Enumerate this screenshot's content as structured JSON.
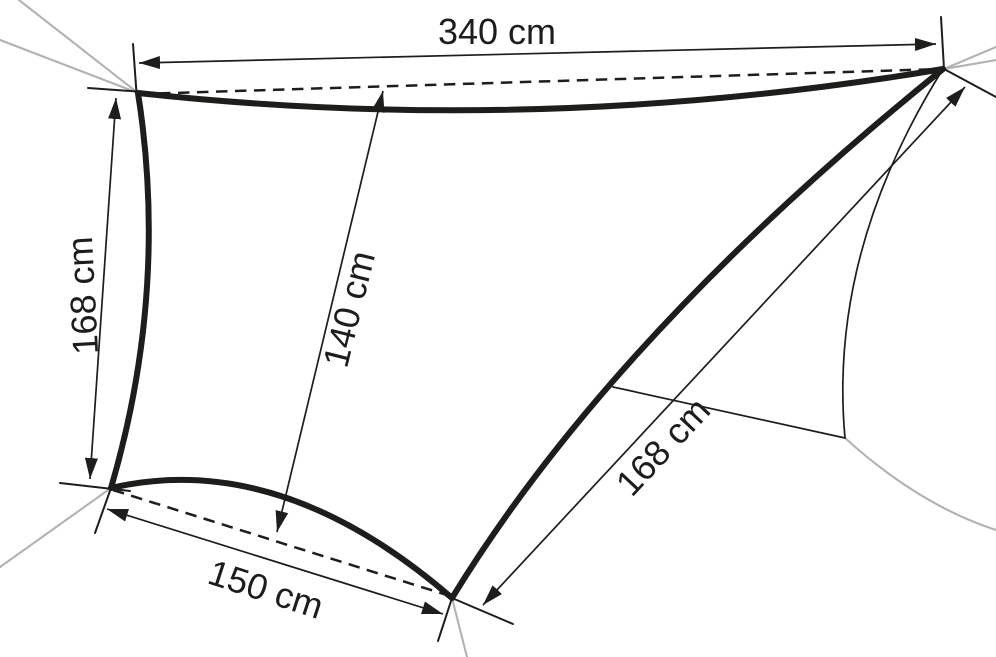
{
  "diagram": {
    "labels": {
      "top_width": "340 cm",
      "left_height": "168 cm",
      "center_height": "140 cm",
      "bottom_width": "150 cm",
      "right_edge": "168 cm"
    },
    "colors": {
      "edge": "#1d1d1b",
      "thin_line": "#1d1d1b",
      "rope": "#b2b2b2",
      "text": "#1d1d1b",
      "background": "#ffffff"
    }
  }
}
